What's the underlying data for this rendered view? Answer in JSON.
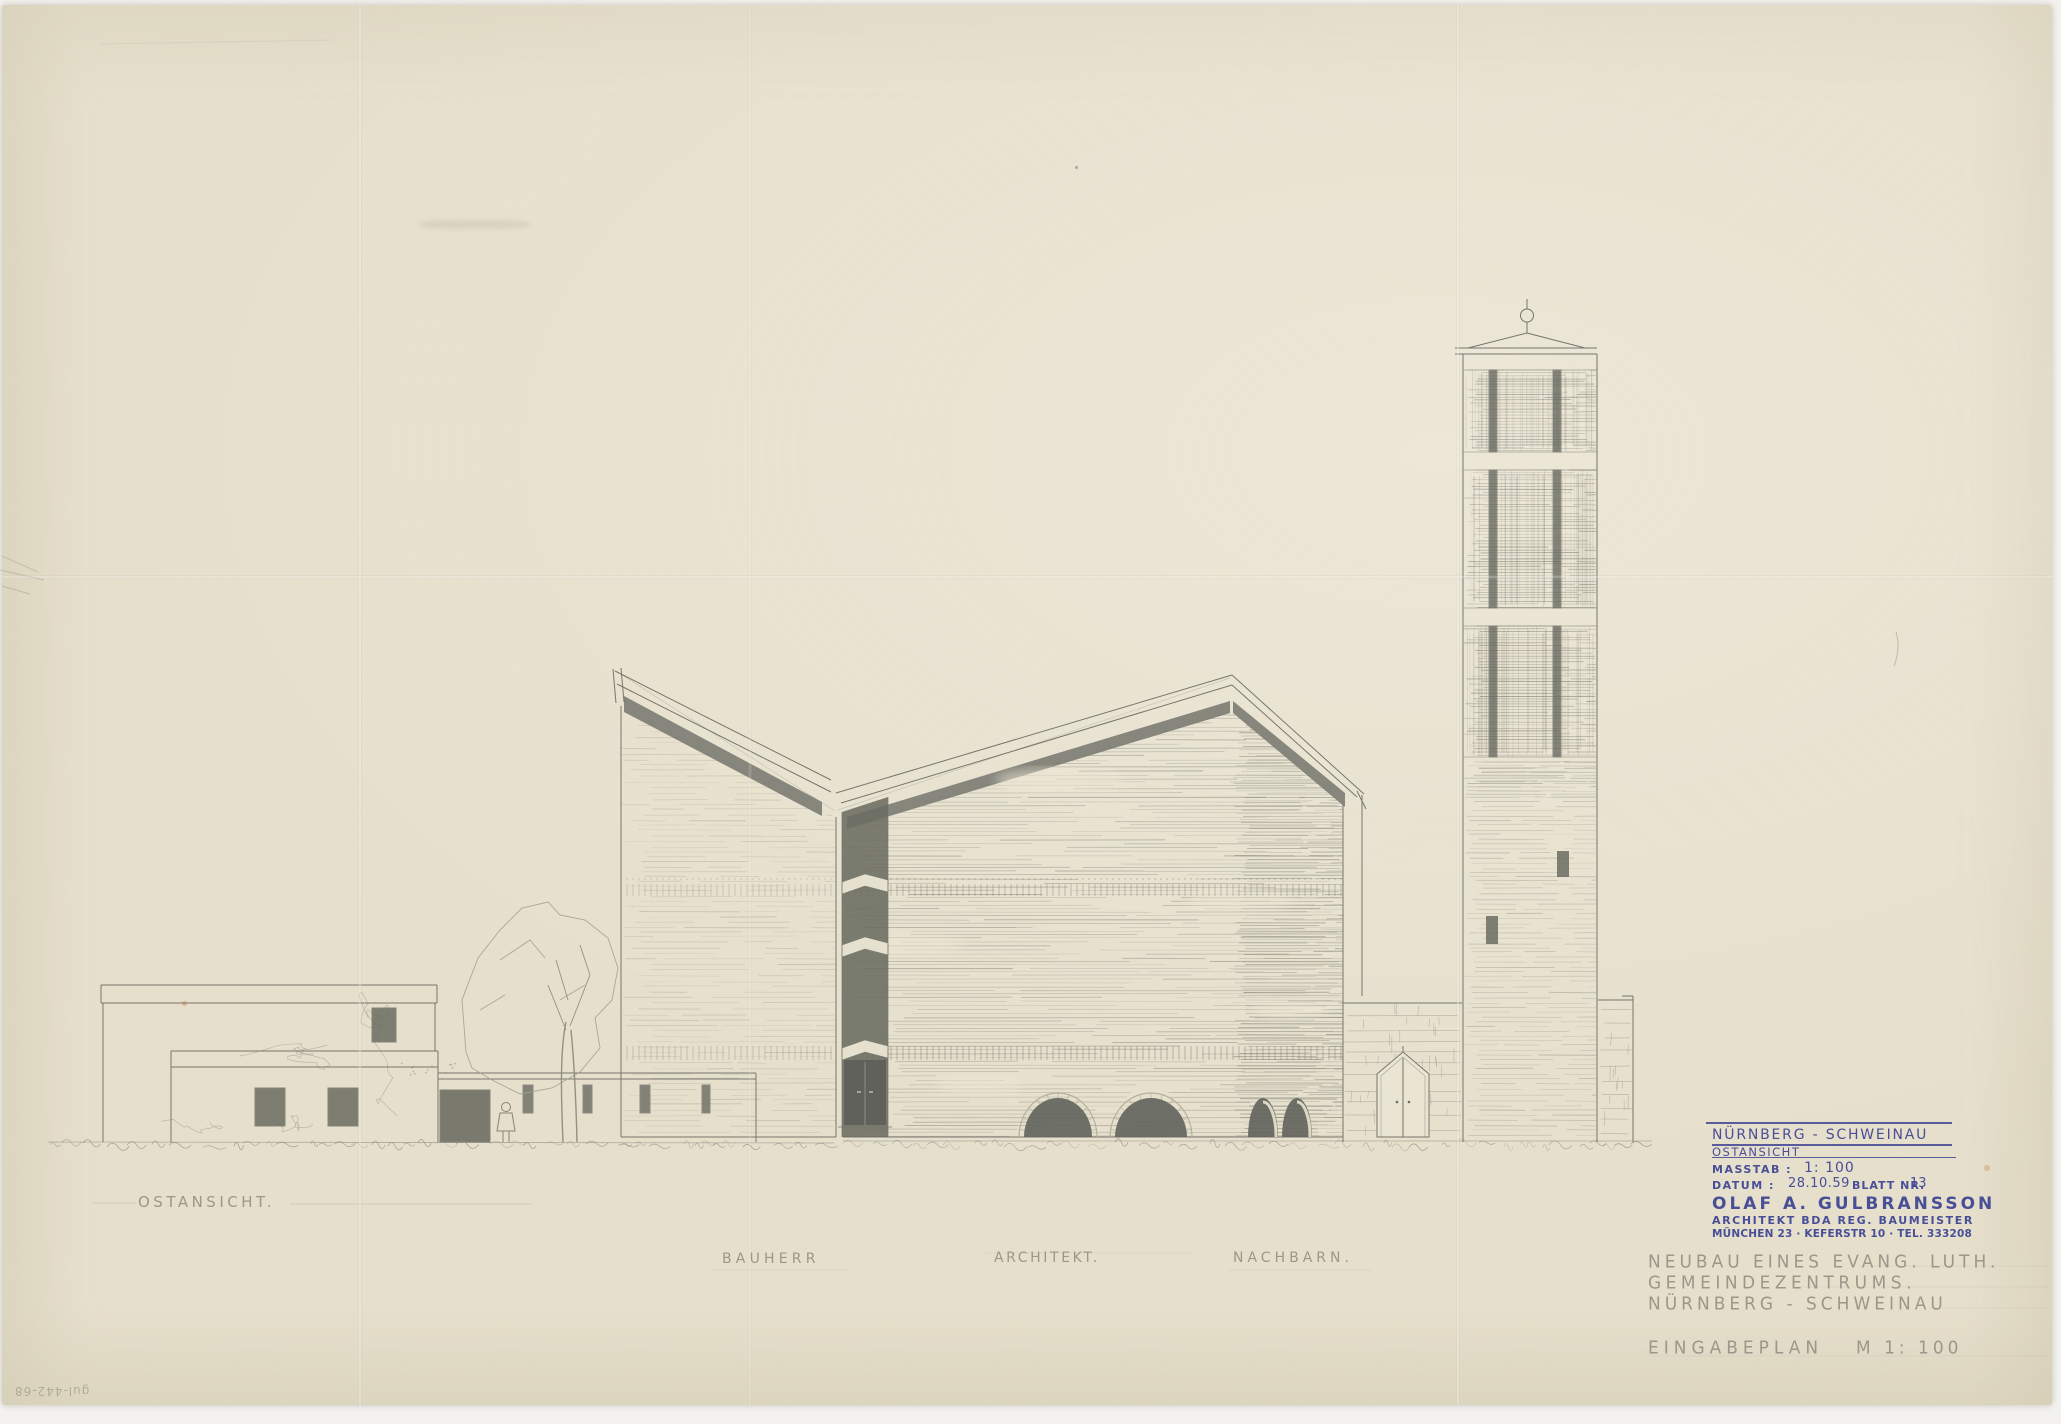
{
  "document": {
    "kind": "scanned architectural elevation drawing (pencil on aged paper)",
    "view": "east elevation of an evangelical-lutheran parish centre with church and bell tower"
  },
  "drawing_labels": {
    "view_label": "OSTANSICHT.",
    "bauherr": "BAUHERR",
    "architekt": "ARCHITEKT.",
    "nachbarn": "NACHBARN."
  },
  "stamp": {
    "location_line": "NÜRNBERG - SCHWEINAU",
    "view_line": "OSTANSICHT",
    "masstab_label": "MASSTAB :",
    "masstab_value": "1: 100",
    "datum_label": "DATUM :",
    "datum_value": "28.10.59",
    "blatt_label": "BLATT NR.",
    "blatt_value": "13",
    "architect_name": "OLAF A. GULBRANSSON",
    "architect_title": "ARCHITEKT BDA REG. BAUMEISTER",
    "architect_address": "MÜNCHEN 23 · KEFERSTR 10 · TEL. 333208"
  },
  "title_block": {
    "line1": "NEUBAU EINES EVANG. LUTH.",
    "line2": "GEMEINDEZENTRUMS.",
    "line3": "NÜRNBERG - SCHWEINAU",
    "plan_type": "EINGABEPLAN",
    "scale": "M 1: 100"
  },
  "archive_number": "gul-442-68",
  "colors": {
    "paper": "#eae4d2",
    "pencil": "#76766c",
    "pencil_light": "#a5a193",
    "dark_fill": "#6b6c62",
    "ink_blue": "#3e4493"
  }
}
